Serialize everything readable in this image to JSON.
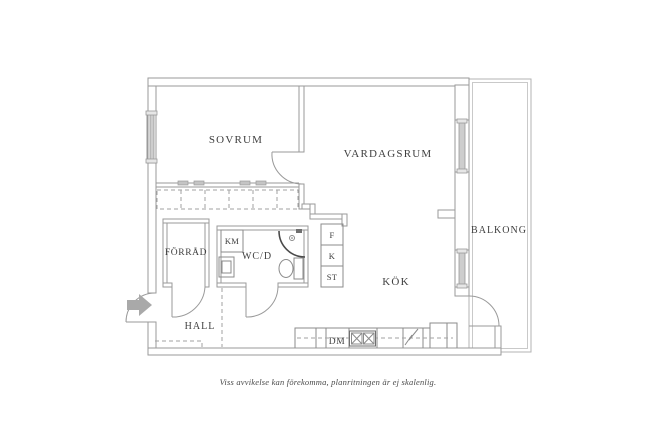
{
  "plan": {
    "rooms": {
      "sovrum": "SOVRUM",
      "vardagsrum": "VARDAGSRUM",
      "balkong": "BALKONG",
      "kok": "KÖK",
      "hall": "HALL",
      "forrad": "FÖRRÅD",
      "wcd": "WC/D"
    },
    "appliances": {
      "km": "KM",
      "f": "F",
      "k": "K",
      "st": "ST",
      "dm": "DM"
    },
    "colors": {
      "wall_line": "#9a9a9a",
      "fixture_line": "#8b8b8b",
      "shower_line": "#4a4a4a",
      "label_text": "#3f3f3f",
      "entrance_arrow": "#a9a9a9",
      "balcony_line": "#b3b3b3"
    }
  },
  "caption": {
    "text": "Viss avvikelse kan förekomma, planritningen är ej skalenlig."
  }
}
